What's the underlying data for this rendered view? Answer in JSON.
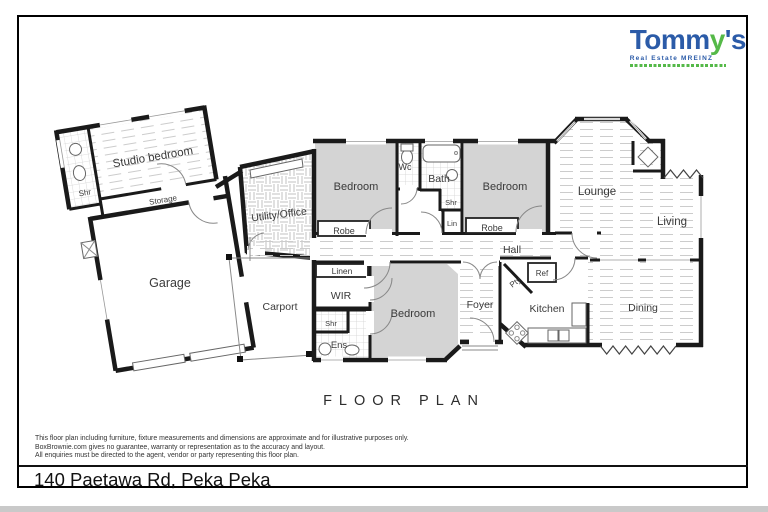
{
  "logo": {
    "brand_t": "Tomm",
    "brand_y": "y",
    "brand_s": "'s",
    "subtitle": "Real Estate MREINZ"
  },
  "title": "FLOOR PLAN",
  "address": "140 Paetawa Rd, Peka Peka",
  "disclaimer": {
    "line1": "This floor plan including furniture, fixture measurements and dimensions are approximate and for illustrative purposes only.",
    "line2": "BoxBrownie.com gives no guarantee, warranty or representation as to the accuracy and layout.",
    "line3": "All enquiries must be directed to the agent, vendor or party representing this floor plan."
  },
  "rooms": {
    "studio": "Studio bedroom",
    "shr": "Shr",
    "storage": "Storage",
    "garage": "Garage",
    "utility": "Utility/Office",
    "carport": "Carport",
    "bedroom": "Bedroom",
    "robe": "Robe",
    "wc": "Wc",
    "bath": "Bath",
    "lin": "Lin",
    "lounge": "Lounge",
    "living": "Living",
    "hall": "Hall",
    "linen": "Linen",
    "wir": "WIR",
    "ens": "Ens",
    "foyer": "Foyer",
    "pty": "Pty",
    "ref": "Ref",
    "kitchen": "Kitchen",
    "dining": "Dining"
  },
  "colors": {
    "wall": "#1a1a1a",
    "room_fill": "#d4d4d4",
    "logo_blue": "#2b5ba8",
    "logo_green": "#55b948"
  }
}
